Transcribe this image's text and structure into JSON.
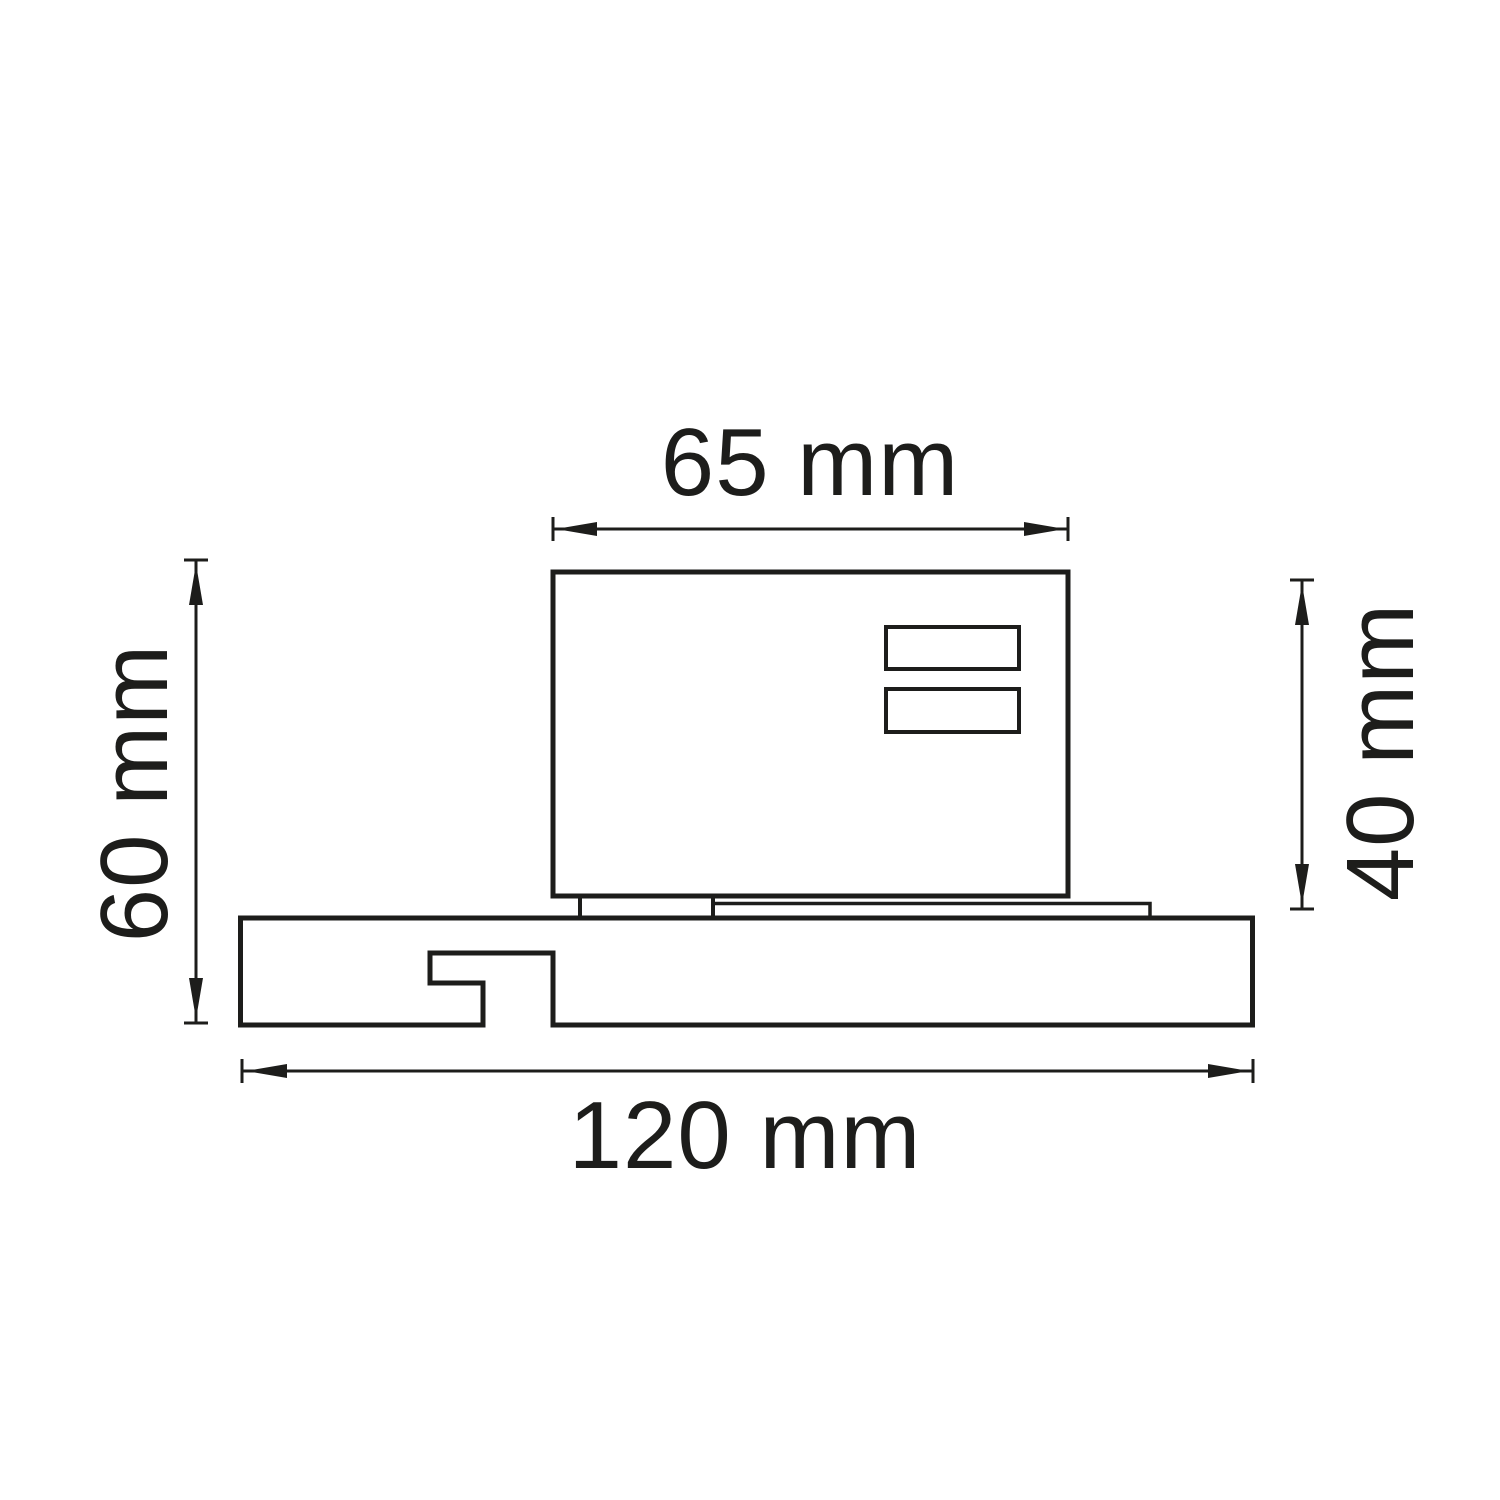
{
  "drawing": {
    "type": "technical-dimension-drawing",
    "subject": "track adapter mounted on track profile, side cross-section view",
    "colors": {
      "line": "#1d1d1b",
      "background": "#ffffff"
    },
    "dimensions": {
      "body_width": {
        "label": "65 mm",
        "orientation": "horizontal",
        "position": "top"
      },
      "body_height": {
        "label": "40 mm",
        "orientation": "vertical",
        "position": "right"
      },
      "total_height": {
        "label": "60 mm",
        "orientation": "vertical",
        "position": "left"
      },
      "base_width": {
        "label": "120 mm",
        "orientation": "horizontal",
        "position": "bottom"
      }
    }
  }
}
